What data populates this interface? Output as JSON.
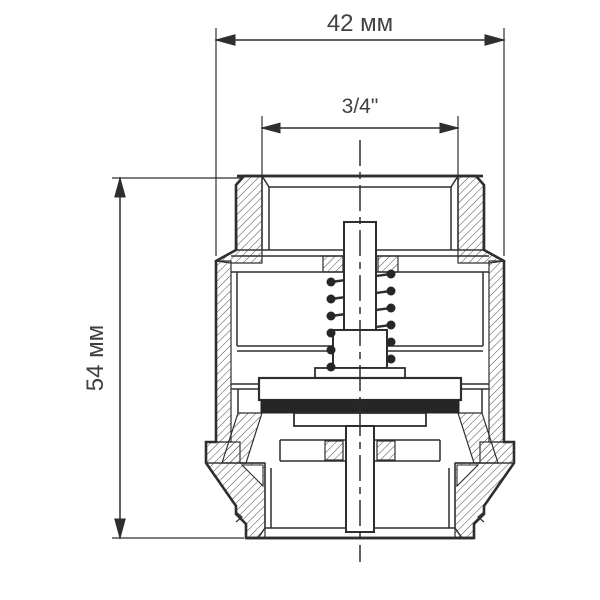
{
  "drawing": {
    "dimensions": {
      "width_label": "42 мм",
      "thread_label": "3/4\"",
      "height_label": "54 мм"
    },
    "colors": {
      "line": "#2e2e2e",
      "text": "#414141",
      "seal": "#262626",
      "background": "#ffffff"
    }
  }
}
